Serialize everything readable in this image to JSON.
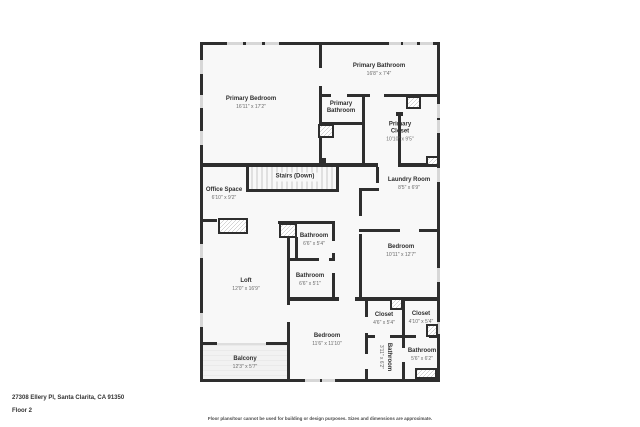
{
  "footer": {
    "address": "27308 Ellery Pl, Santa Clarita, CA 91350",
    "floor": "Floor 2",
    "disclaimer": "Floor plans/tour cannot be used for building or design purposes. Sizes and dimensions are approximate."
  },
  "colors": {
    "wall": "#2e2e2e",
    "room_fill": "#f8f8f8",
    "window": "#d7d7d7",
    "name_text": "#2f2f2f",
    "dim_text": "#666666"
  },
  "rooms": [
    {
      "name": "Primary Bedroom",
      "dims": "16'11\" x 17'2\""
    },
    {
      "name": "Primary Bathroom",
      "dims": "16'8\" x 7'4\""
    },
    {
      "name": "Primary Bathroom",
      "dims": ""
    },
    {
      "name": "Primary Closet",
      "dims": "10'10\" x 9'5\""
    },
    {
      "name": "Stairs (Down)",
      "dims": ""
    },
    {
      "name": "Office Space",
      "dims": "6'10\" x 9'2\""
    },
    {
      "name": "Laundry Room",
      "dims": "8'5\" x 6'9\""
    },
    {
      "name": "Bedroom",
      "dims": "10'11\" x 12'7\""
    },
    {
      "name": "Bathroom",
      "dims": "6'6\" x 5'4\""
    },
    {
      "name": "Bathroom",
      "dims": "6'6\" x 5'1\""
    },
    {
      "name": "Loft",
      "dims": "12'0\" x 16'9\""
    },
    {
      "name": "Bedroom",
      "dims": "11'6\" x 11'10\""
    },
    {
      "name": "Closet",
      "dims": "4'6\" x 5'4\""
    },
    {
      "name": "Closet",
      "dims": "4'10\" x 5'4\""
    },
    {
      "name": "Bathroom",
      "dims": "3'11\" x 6'2\""
    },
    {
      "name": "Bathroom",
      "dims": "5'6\" x 6'2\""
    },
    {
      "name": "Balcony",
      "dims": "12'3\" x 5'7\""
    }
  ]
}
